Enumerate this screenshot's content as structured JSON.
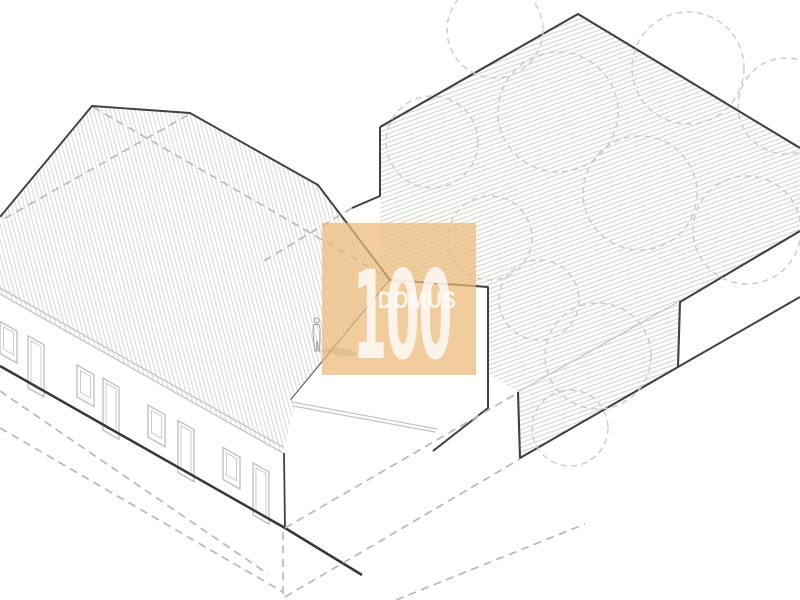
{
  "watermark": {
    "number": "100",
    "word": "DOMUS"
  },
  "palette": {
    "background": "#ffffff",
    "outline_dark": "#3d4145",
    "line_light": "#c0c5c6",
    "hatch_roof": "#d6dbd4",
    "hatch_garden": "#d0d7cf",
    "dashed_gray": "#b5babc",
    "tree_dashed": "#c8cdc8",
    "watermark_orange": "rgba(236,186,121,0.72)",
    "watermark_text": "rgba(255,255,255,0.78)"
  },
  "drawing": {
    "window_positions": [
      0,
      77,
      148,
      223
    ],
    "door_positions": [
      28,
      103,
      178,
      253
    ],
    "tree_circles": [
      [
        495,
        30,
        48
      ],
      [
        558,
        112,
        60
      ],
      [
        432,
        142,
        46
      ],
      [
        688,
        68,
        56
      ],
      [
        786,
        106,
        48
      ],
      [
        640,
        193,
        57
      ],
      [
        747,
        230,
        54
      ],
      [
        490,
        238,
        42
      ],
      [
        539,
        300,
        40
      ],
      [
        598,
        356,
        53
      ],
      [
        570,
        428,
        38
      ]
    ]
  }
}
